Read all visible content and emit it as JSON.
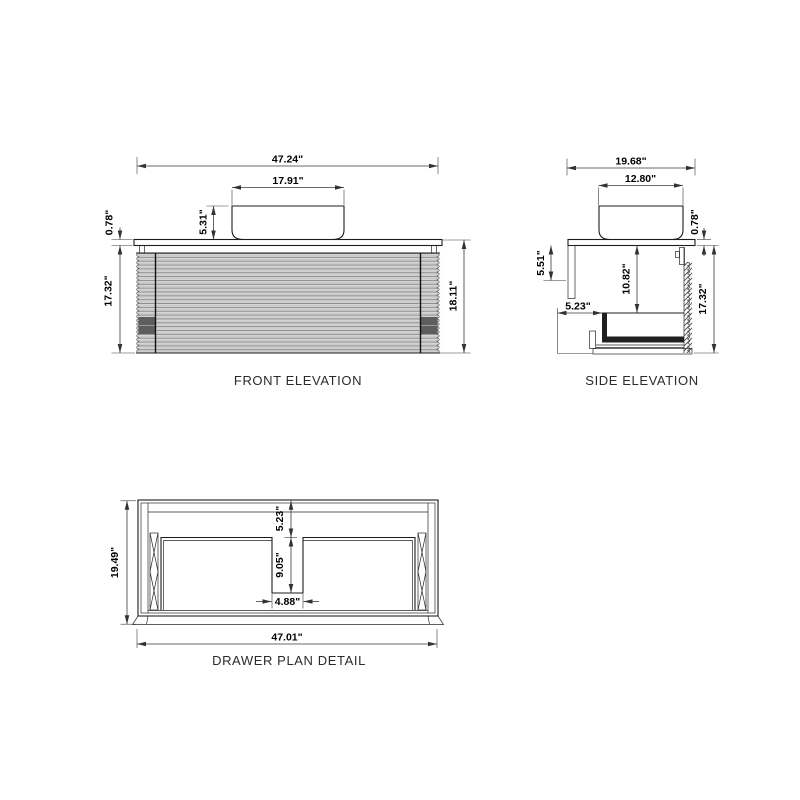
{
  "front": {
    "title": "FRONT ELEVATION",
    "dims": {
      "overall_width": "47.24\"",
      "sink_width": "17.91\"",
      "sink_height": "5.31\"",
      "countertop_thickness": "0.78\"",
      "cabinet_height": "17.32\"",
      "overall_height": "18.11\""
    }
  },
  "side": {
    "title": "SIDE ELEVATION",
    "dims": {
      "overall_depth": "19.68\"",
      "sink_depth": "12.80\"",
      "countertop_thickness": "0.78\"",
      "cleat_height": "5.51\"",
      "interior_height": "10.82\"",
      "drawer_depth": "5.23\"",
      "cabinet_height": "17.32\""
    }
  },
  "plan": {
    "title": "DRAWER PLAN DETAIL",
    "dims": {
      "overall_depth": "19.49\"",
      "back_offset": "5.23\"",
      "notch_depth": "9.05\"",
      "notch_width": "4.88\"",
      "overall_width": "47.01\""
    }
  }
}
